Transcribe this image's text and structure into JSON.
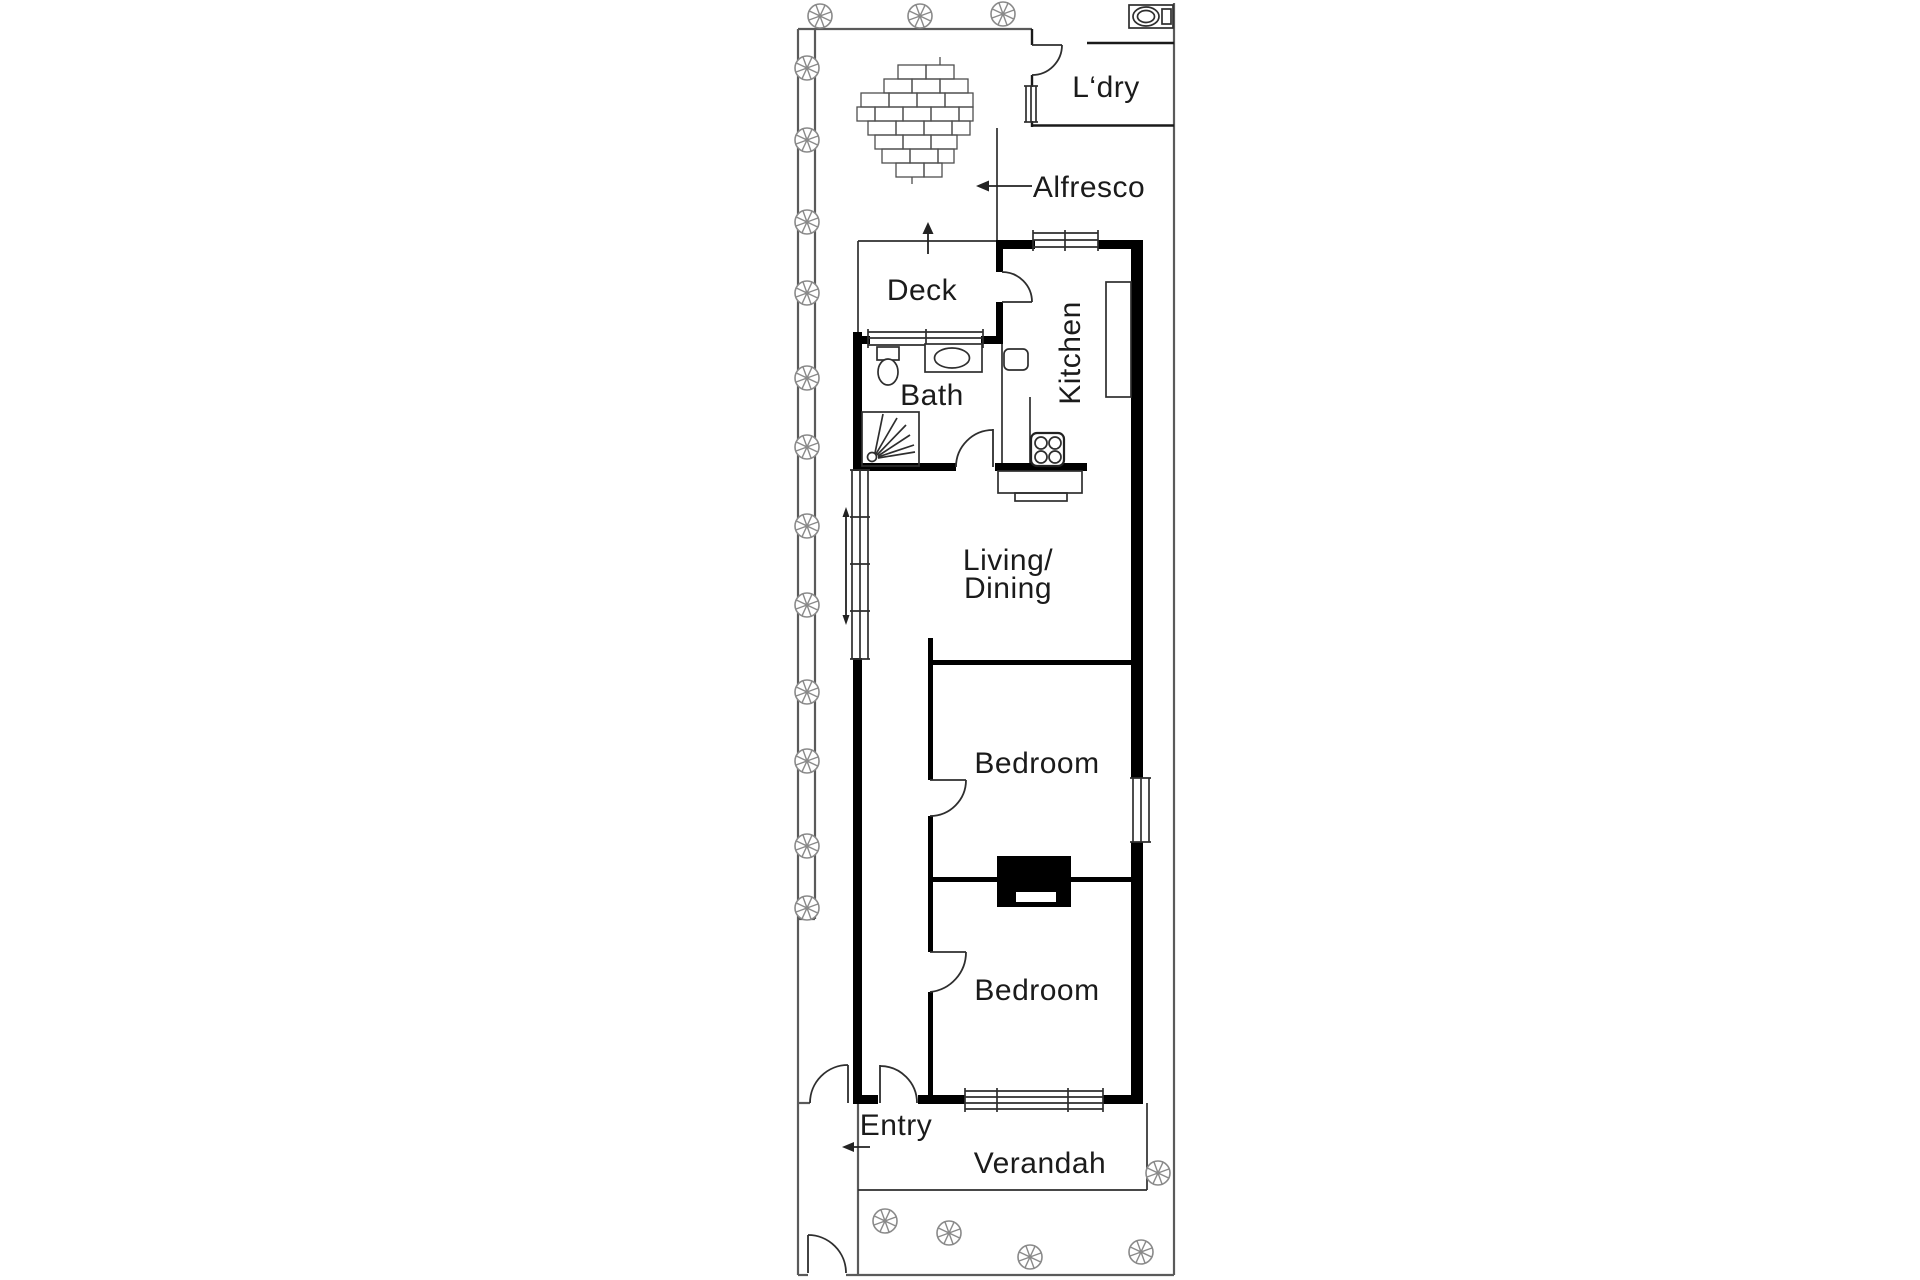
{
  "floorplan": {
    "rooms": {
      "laundry": "L‘dry",
      "alfresco": "Alfresco",
      "deck": "Deck",
      "kitchen": "Kitchen",
      "bath": "Bath",
      "living_line1": "Living/",
      "living_line2": "Dining",
      "bedroom_front": "Bedroom",
      "bedroom_rear": "Bedroom",
      "entry": "Entry",
      "verandah": "Verandah"
    },
    "colors": {
      "wall": "#000000",
      "line": "#2e2e2e",
      "fence": "#5a5a5a",
      "tree": "#8a8a8a",
      "text": "#1b1b1b",
      "background": "#ffffff"
    }
  }
}
